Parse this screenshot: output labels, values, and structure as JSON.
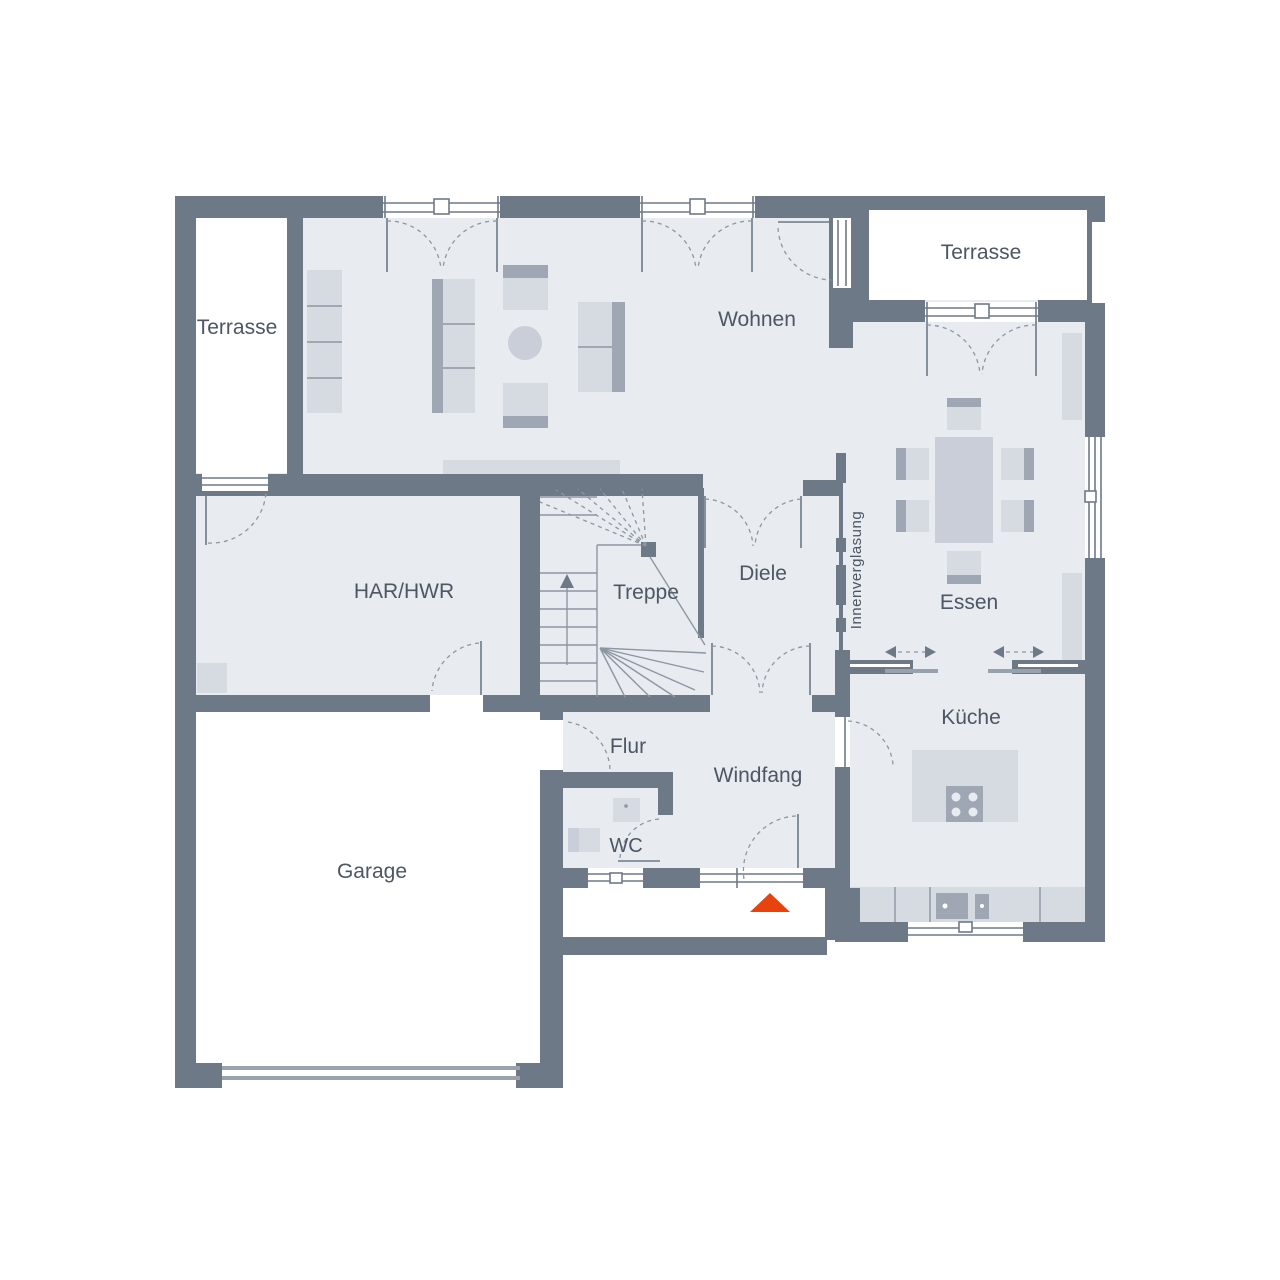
{
  "floorplan": {
    "rooms": {
      "terrasse_left": {
        "label": "Terrasse"
      },
      "terrasse_right": {
        "label": "Terrasse"
      },
      "wohnen": {
        "label": "Wohnen"
      },
      "har_hwr": {
        "label": "HAR/HWR"
      },
      "treppe": {
        "label": "Treppe"
      },
      "diele": {
        "label": "Diele"
      },
      "essen": {
        "label": "Essen"
      },
      "kueche": {
        "label": "Küche"
      },
      "flur": {
        "label": "Flur"
      },
      "windfang": {
        "label": "Windfang"
      },
      "wc": {
        "label": "WC"
      },
      "garage": {
        "label": "Garage"
      }
    },
    "annotations": {
      "innenverglasung": {
        "label": "Innenverglasung"
      }
    },
    "colors": {
      "wall": "#6e7987",
      "floor": "#e8ebf0",
      "furniture_light": "#d6dae1",
      "furniture_mid": "#c9ced8",
      "furniture_dark": "#9fa7b4",
      "line": "#8d96a3",
      "text": "#4d5663",
      "entrance_marker": "#e8430e",
      "background": "#ffffff"
    }
  }
}
